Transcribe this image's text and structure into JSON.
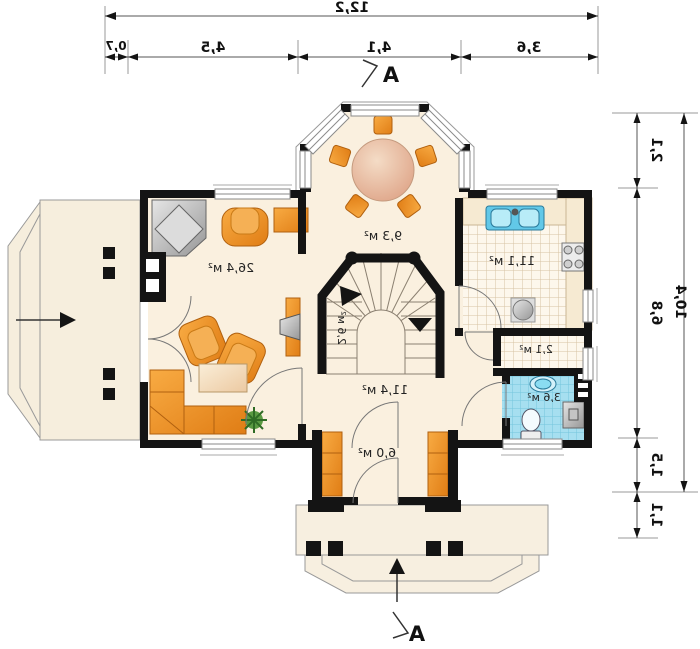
{
  "plan": {
    "section_marker": "A",
    "dimensions": {
      "top": {
        "total": "12,2",
        "segments": [
          "0,7",
          "4,5",
          "4,1",
          "3,6"
        ]
      },
      "right": {
        "total": "10,4",
        "segments": [
          "2,1",
          "6,8",
          "1,5",
          "1,1"
        ]
      }
    },
    "rooms": [
      {
        "id": "living-room",
        "area": "26,4 м²"
      },
      {
        "id": "dining-bay",
        "area": "9,3 м²"
      },
      {
        "id": "kitchen",
        "area": "11,1 м²"
      },
      {
        "id": "stairs",
        "area": "2,6 м²"
      },
      {
        "id": "hall",
        "area": "11,4 м²"
      },
      {
        "id": "pantry-wc",
        "area": "2,1 м²"
      },
      {
        "id": "bathroom",
        "area": "3,6 м²"
      },
      {
        "id": "entrance-hall",
        "area": "6,0 м²"
      }
    ],
    "colors": {
      "wall": "#141414",
      "floor": "#faf0df",
      "terrace": "#f6eedd",
      "furniture_orange": "#ef8f2a",
      "bathroom_tile": "#a6dff0",
      "kitchen_tile_line": "#d6c3a4",
      "dimension_line": "#555555"
    }
  }
}
